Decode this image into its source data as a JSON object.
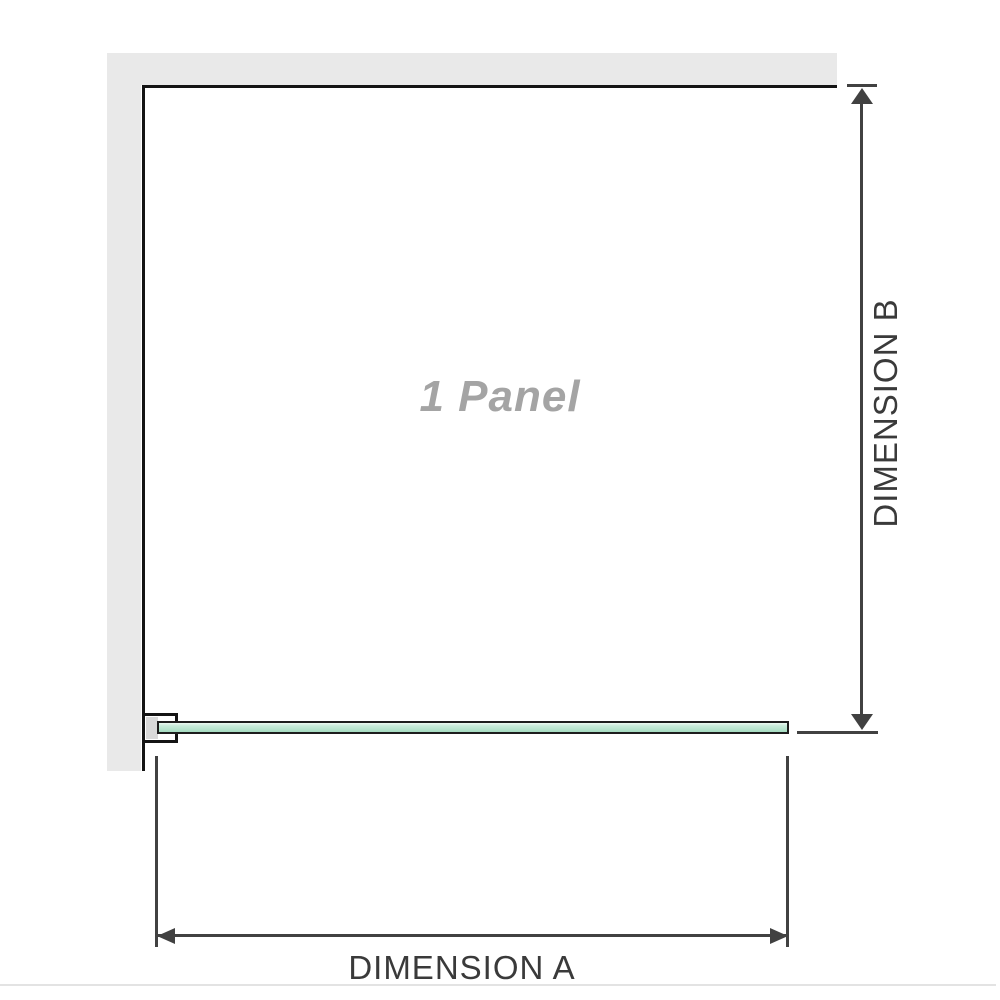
{
  "diagram": {
    "panel_label": "1 Panel",
    "dimension_a": {
      "label": "DIMENSION A"
    },
    "dimension_b": {
      "label": "DIMENSION B"
    }
  },
  "colors": {
    "wall_gray": "#e9e9e9",
    "outline_black": "#141414",
    "dimension_gray": "#414141",
    "label_gray": "#3a3a3a",
    "panel_label_gray": "#a4a4a4",
    "glass_green_highlight": "#edf9f2",
    "glass_green_light": "#c9ebda",
    "glass_green": "#a6dcc1",
    "glass_border": "#1d1d1d",
    "bracket_fill_gray": "#d9d9d9",
    "faint_rule_gray": "#e3e3e3"
  }
}
